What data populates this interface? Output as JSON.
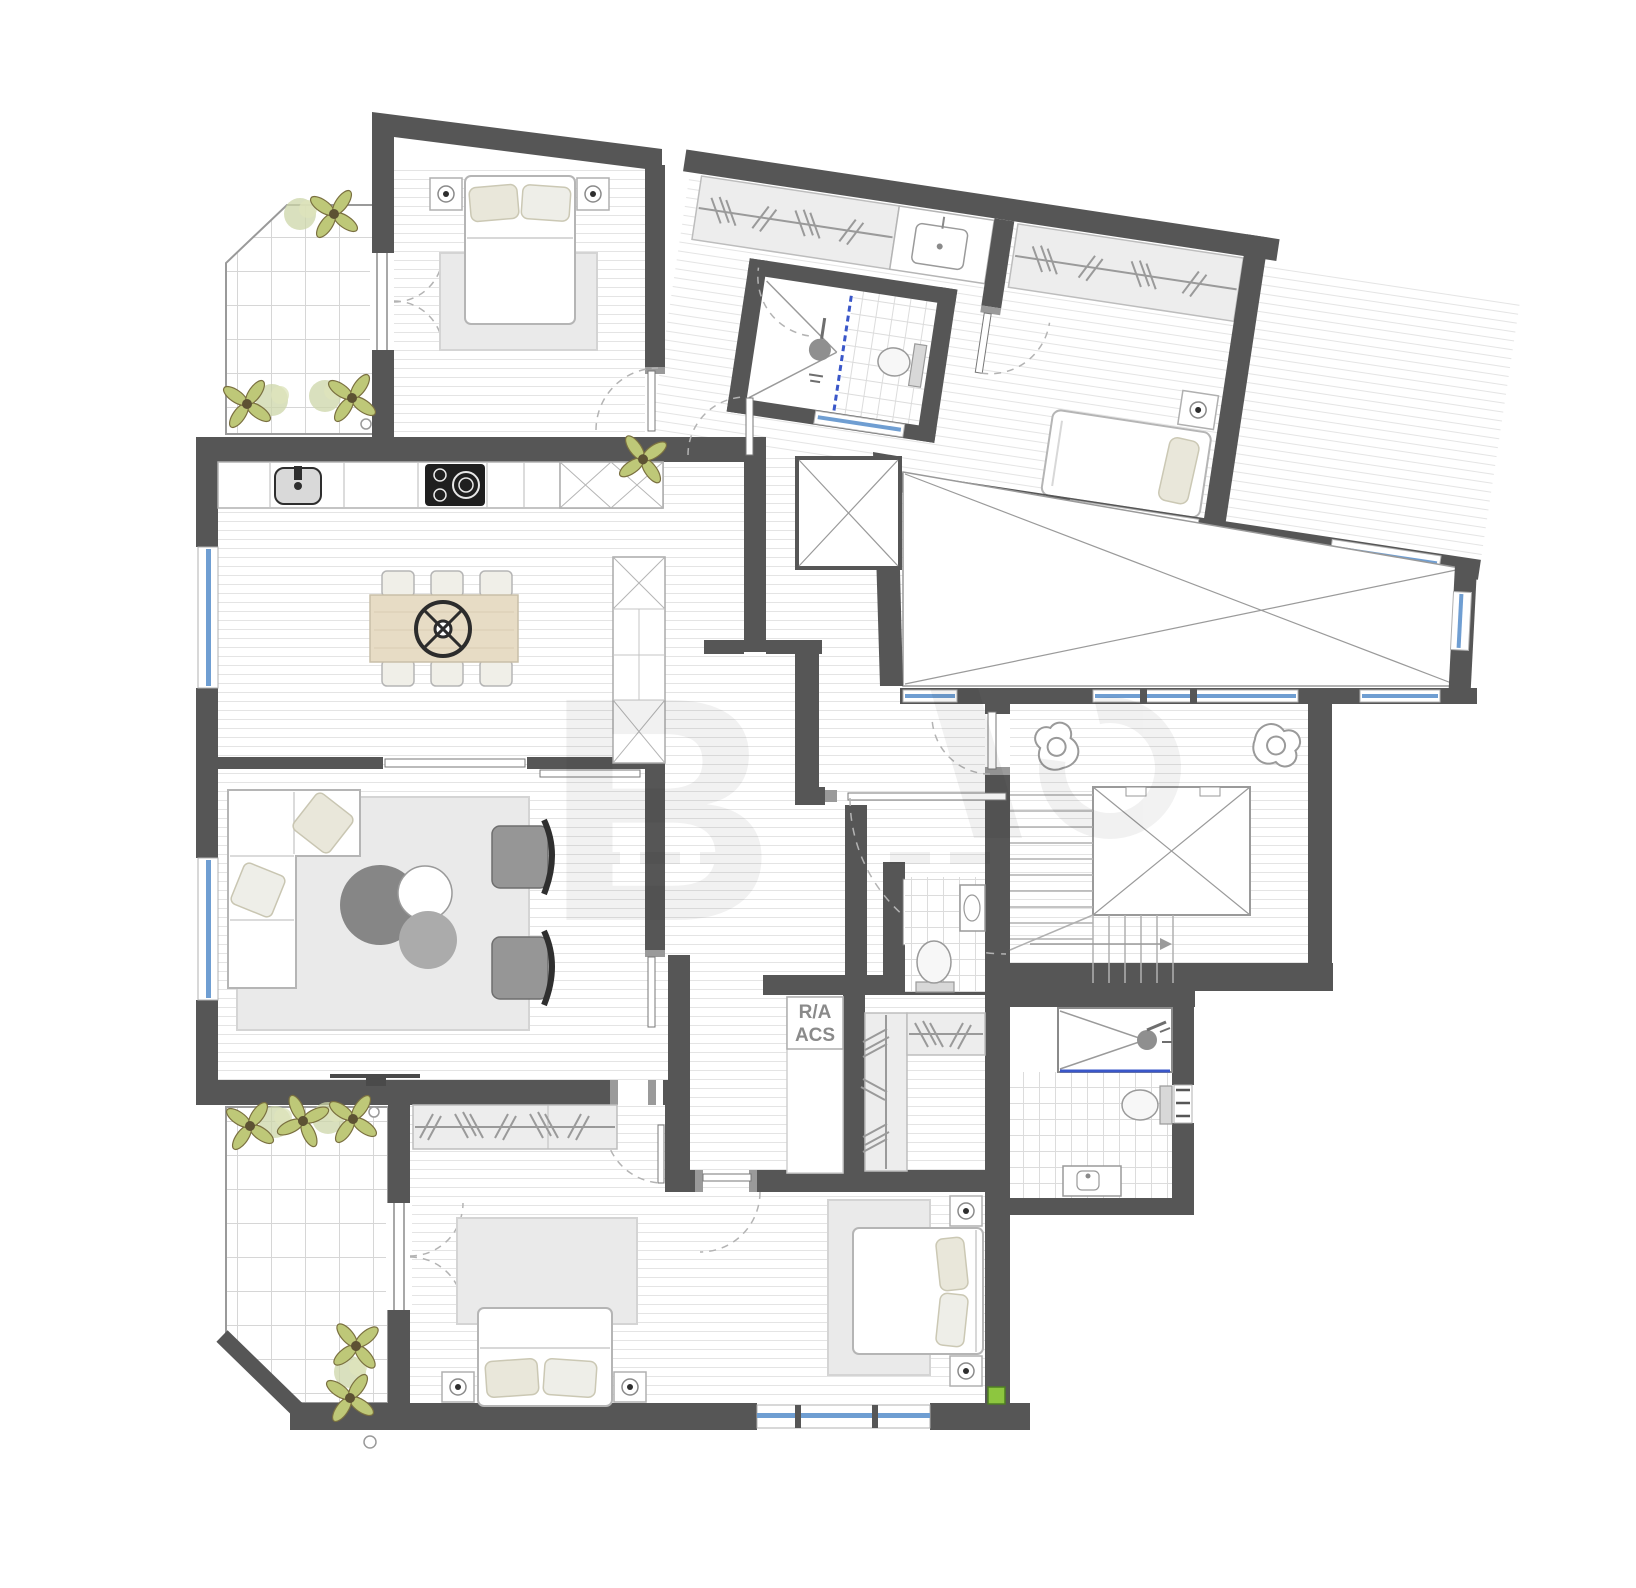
{
  "plan": {
    "type": "residential-floor-plan",
    "labels": {
      "technical_closet_line1": "R/A",
      "technical_closet_line2": "ACS"
    },
    "colors": {
      "wall": "#565656",
      "wall_light": "#9a9a9a",
      "window_glass": "#6f9ed2",
      "shower_glass": "#3a57c9",
      "floor_line": "#e4e4e4",
      "rug": "#eaeaea",
      "table_wood": "#e7dcc5",
      "pillow": "#e9e7da",
      "plant": "#bec878",
      "plant_dark": "#5d5233",
      "marker_green": "#8dc63f",
      "furniture_stroke": "#b5b5b5",
      "fixture_gray": "#8f8f8f",
      "background": "#ffffff"
    },
    "icons": {
      "double-bed-icon": "rounded rectangle with two pillows",
      "single-bed-icon": "rounded rectangle with one pillow",
      "wardrobe-hangers-icon": "rail line with slanted hanger strokes",
      "dining-table-icon": "wood rectangle with six chairs",
      "table-centerpiece-icon": "spoked wheel circle",
      "sofa-icon": "L-shaped sofa with cushions",
      "armchair-icon": "gray chair with dark curved back",
      "coffee-table-icon": "three overlapping circles",
      "kitchen-sink-icon": "rounded square with faucet",
      "cooktop-icon": "black rectangle with burner circles",
      "vanity-sink-icon": "rectangle with basin",
      "toilet-icon": "bowl ellipse with tank",
      "shower-icon": "rectangle with diagonals and shower head",
      "plant-icon": "four leaf petals with dark center",
      "person-top-view-icon": "blob outline with head circle",
      "elevator-icon": "rectangle with X diagonals",
      "stairs-icon": "treads with direction arrow",
      "tv-icon": "thin dark line on wall",
      "window-icon": "blue glazing strip in wall gap",
      "door-swing-icon": "dashed quarter arc with leaf",
      "courtyard-x-icon": "large crossed diagonals",
      "green-marker-icon": "small green square"
    },
    "watermark": {
      "present": true
    }
  }
}
